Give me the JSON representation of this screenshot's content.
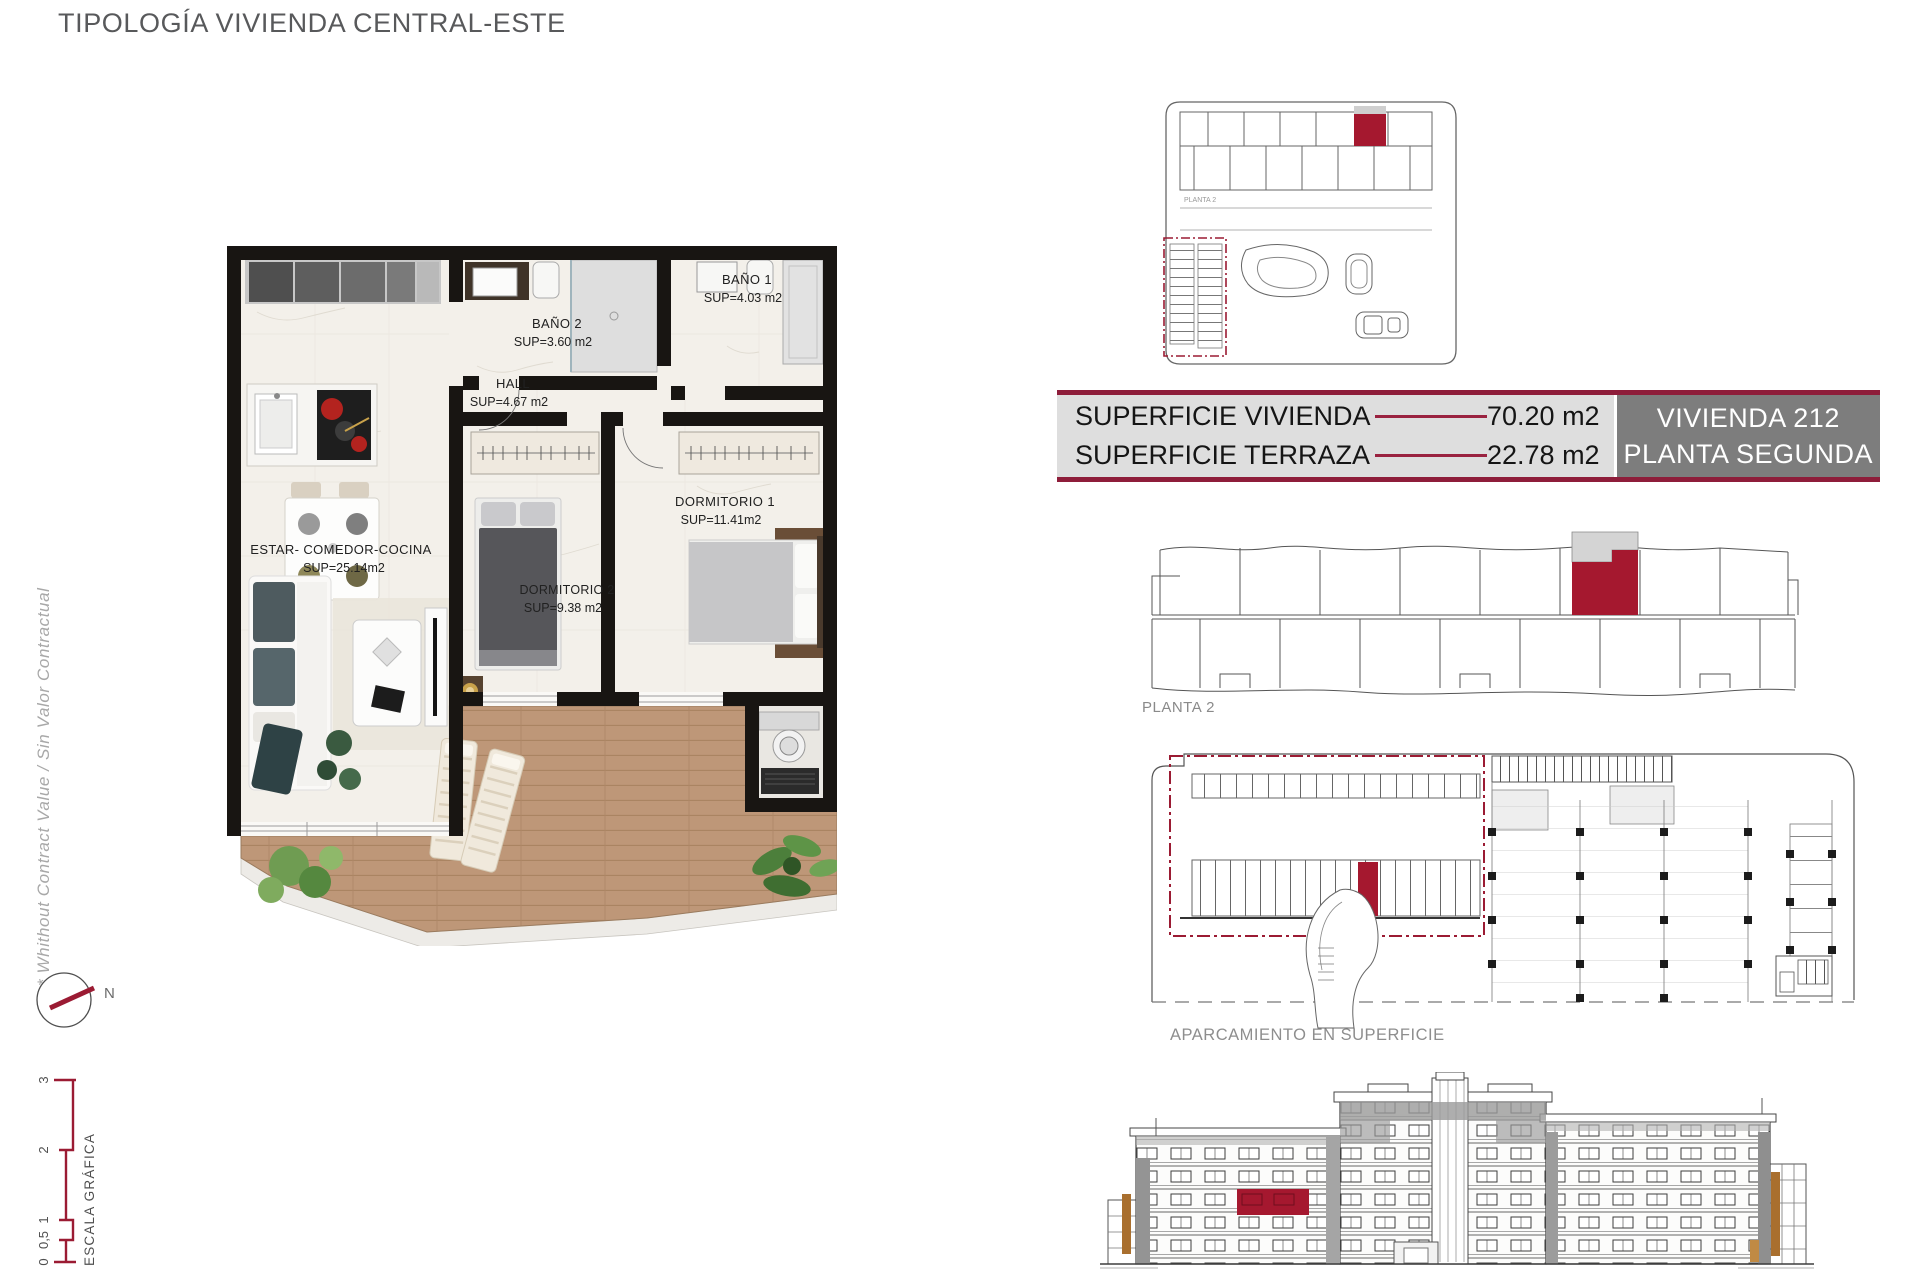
{
  "header": {
    "title": "TIPOLOGÍA VIVIENDA CENTRAL-ESTE"
  },
  "disclaimer": {
    "text": "* Whithout Contract Value / Sin Valor Contractual"
  },
  "compass": {
    "north_label": "N"
  },
  "scale_bar": {
    "title": "ESCALA GRÁFICA",
    "ticks": [
      "0",
      "0,5",
      "1",
      "2",
      "3"
    ]
  },
  "floor_plan": {
    "rooms": [
      {
        "name": "BAÑO 2",
        "area": "SUP=3.60 m2"
      },
      {
        "name": "BAÑO 1",
        "area": "SUP=4.03 m2"
      },
      {
        "name": "HALL",
        "area": "SUP=4.67 m2"
      },
      {
        "name": "DORMITORIO 1",
        "area": "SUP=11.41m2"
      },
      {
        "name": "DORMITORIO 2",
        "area": "SUP=9.38 m2"
      },
      {
        "name": "ESTAR- COMEDOR-COCINA",
        "area": "SUP=25.14m2"
      }
    ]
  },
  "site_plan": {
    "label": "PLANTA 2"
  },
  "info_panel": {
    "rows": [
      {
        "label": "SUPERFICIE VIVIENDA",
        "value": "70.20 m2"
      },
      {
        "label": "SUPERFICIE TERRAZA",
        "value": "22.78 m2"
      }
    ],
    "unit_name": "VIVIENDA 212",
    "unit_floor": "PLANTA SEGUNDA"
  },
  "floor_strip": {
    "label": "PLANTA 2"
  },
  "parking_plan": {
    "label": "APARCAMIENTO EN SUPERFICIE"
  },
  "colors": {
    "accent": "#9B1B33",
    "highlight_fill": "#A5182F",
    "table_bg": "#DEDEDE",
    "unit_box_bg": "#7D7D7D",
    "title_gray": "#58595B",
    "drawing_line": "#4A4A4A",
    "wood_deck": "#BE9778",
    "wall_black": "#181512"
  }
}
